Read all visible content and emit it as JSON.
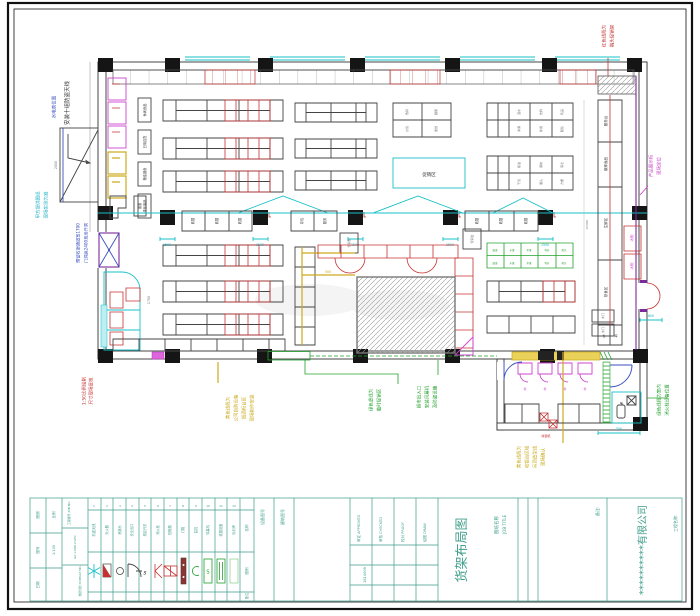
{
  "sheet": {
    "company": "**********有限公司",
    "project_label": "工程名称:",
    "note_label": "备注:",
    "title_label_cn": "图纸名称",
    "title_label_en": "JOB TITLE",
    "drawing_title": "货架布局图",
    "left_block": {
      "c1r1": "图别",
      "c1r2": "图号",
      "c1r3": "日期",
      "c2r1": "比例",
      "c2r2": "1:100",
      "job_no_label": "工程编号 JOB NO.",
      "job_no": "G2.110812 LPIC",
      "consult": "楼层规划 CONSULT NO."
    },
    "roles": [
      {
        "label": "审定 APPROVED",
        "no": "1814009"
      },
      {
        "label": "审核 CHECKED",
        "no": ""
      },
      {
        "label": "校对 PROOF",
        "no": ""
      },
      {
        "label": "绘图 DRAW",
        "no": ""
      }
    ],
    "misc_cols": [
      "设备图号",
      "建筑图号"
    ],
    "legend_headers": {
      "name": "名称",
      "symbol": "图例",
      "note": "备注"
    }
  },
  "legend": {
    "items": [
      {
        "no": "1",
        "name": "防盗天线"
      },
      {
        "no": "2",
        "name": "灭火器"
      },
      {
        "no": "3",
        "name": "喷淋头"
      },
      {
        "no": "4",
        "name": "安全出口"
      },
      {
        "no": "5",
        "name": "感应开关"
      },
      {
        "no": "6",
        "name": "消火栓"
      },
      {
        "no": "7",
        "name": "配电箱"
      },
      {
        "no": "8",
        "name": "灯箱"
      },
      {
        "no": "9",
        "name": "监控"
      },
      {
        "no": "10",
        "name": "风幕机"
      },
      {
        "no": "11",
        "name": "收银设备"
      },
      {
        "no": "12",
        "name": "标识牌"
      }
    ]
  },
  "annotations": {
    "topleft_black": {
      "lines": [
        "安装十组防盗天线"
      ]
    },
    "left_blue_small": {
      "lines": [
        "水电表位置"
      ]
    },
    "left_cyan": {
      "lines": [
        "甲方提供图纸",
        "现场实测为准"
      ]
    },
    "left_blue_long": {
      "lines": [
        "预留收银通道宽1700",
        "门洞高2400现场开洞"
      ]
    },
    "left_red": {
      "lines": [
        "1:50比例绘制",
        "尺寸现场复核"
      ]
    },
    "bottom_yellow": {
      "lines": [
        "黄色线段为",
        "公司自购设备",
        "烟酒柜台区",
        "现场制作安装"
      ]
    },
    "bottom_green_a": {
      "lines": [
        "绿色虚线为",
        "临时促销区"
      ]
    },
    "bottom_green_b": {
      "lines": [
        "超市出入口",
        "安装风幕机",
        "及防盗设施"
      ]
    },
    "annex_yellow": {
      "lines": [
        "黄色线段为",
        "收银台区域",
        "吊顶造型线",
        "现场确认"
      ]
    },
    "right_green": {
      "lines": [
        "绿色线段为室内",
        "消火栓设备位置"
      ]
    },
    "topright_red": {
      "lines": [
        "红色线段为",
        "端头促销架"
      ]
    },
    "right_magenta": {
      "lines": [
        "产品展示柜",
        "现场定位"
      ]
    }
  },
  "plan": {
    "aisle_labels": [
      "休闲食品",
      "日用百货",
      "粮油副食",
      "洗化用品"
    ],
    "checkout_label": "收银",
    "service_labels": [
      "存包",
      "服务"
    ],
    "promo_box": "促销台",
    "promo_area": "促销区",
    "right_counter": [
      "服务台",
      "散称食品",
      "生鲜区",
      "熟食区"
    ],
    "right_counter_small": [
      "仓",
      "库"
    ],
    "freezer": "冰柜",
    "door_box": "木门",
    "gridA": [
      "散称",
      "糖果",
      "炒货",
      "蜜饯"
    ],
    "gridB": [
      "酒水",
      "饮料",
      "乳品",
      "冲调",
      "休闲",
      "膨化"
    ],
    "gridC": [
      "粮油",
      "调味",
      "南北",
      "干货",
      "罐头",
      "方便"
    ],
    "green_cells": [
      "蔬菜",
      "水果",
      "干果",
      "特价",
      "堆头"
    ],
    "counter_l": "客服",
    "annex": {
      "scale": "秤",
      "checkout": "收银机"
    },
    "dims": {
      "checkout": "1500",
      "door_right": "600",
      "annex": "500",
      "ramp": "2000",
      "aisle": "1700",
      "depth": "15300",
      "inner": "500"
    }
  }
}
